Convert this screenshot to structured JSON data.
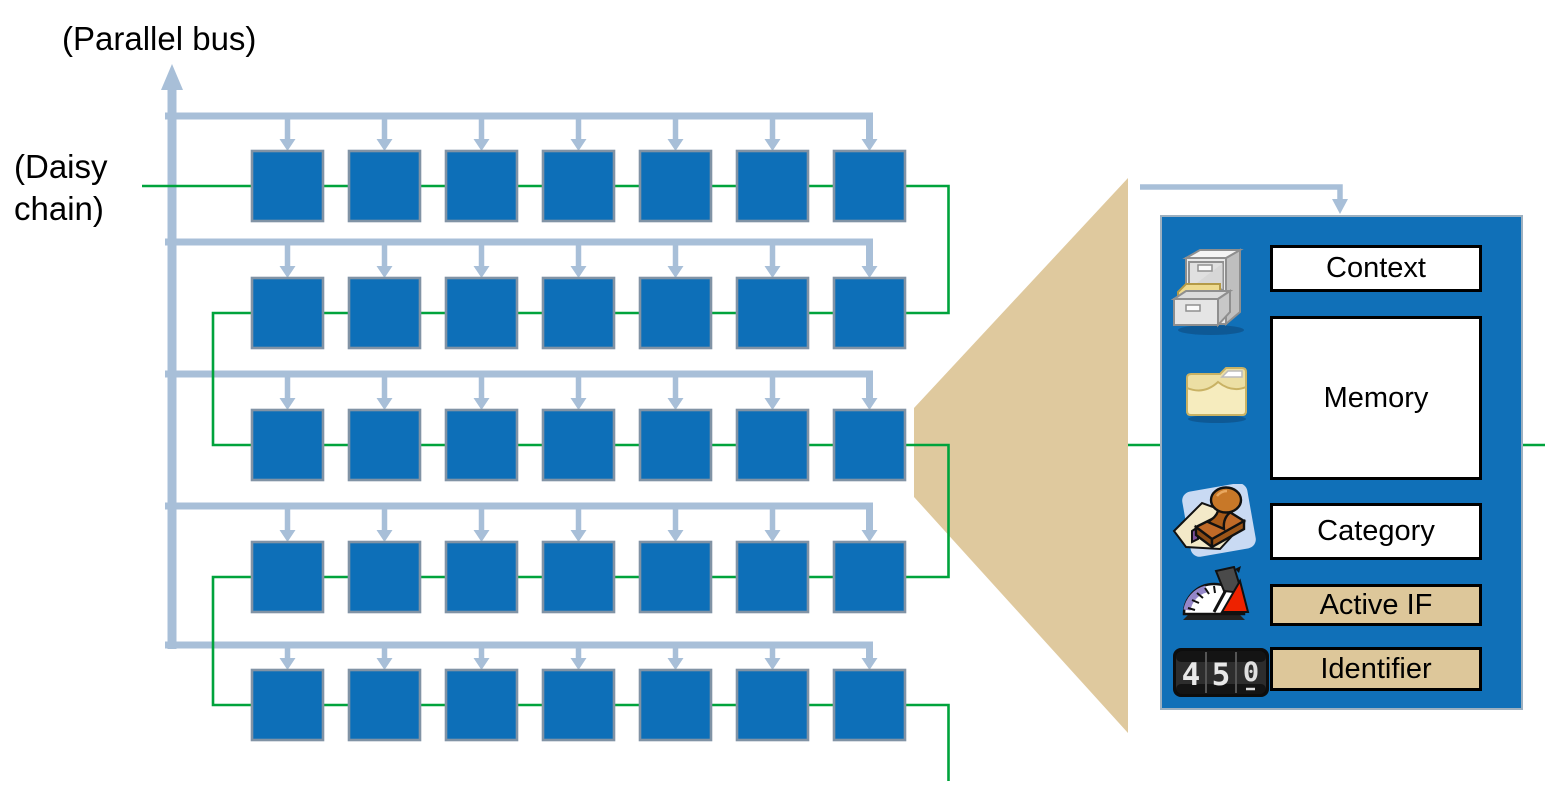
{
  "labels": {
    "parallel_bus": "(Parallel bus)",
    "daisy_chain_line1": "(Daisy",
    "daisy_chain_line2": "chain)"
  },
  "grid": {
    "rows": 5,
    "cols": 7
  },
  "zoom_panel": {
    "fields": [
      {
        "label": "Context",
        "fill": "white",
        "icon": "file-cabinet-icon"
      },
      {
        "label": "Memory",
        "fill": "white",
        "icon": "folder-icon"
      },
      {
        "label": "Category",
        "fill": "white",
        "icon": "stamp-icon"
      },
      {
        "label": "Active IF",
        "fill": "tan",
        "icon": "gauge-icon"
      },
      {
        "label": "Identifier",
        "fill": "tan",
        "icon": "counter-icon"
      }
    ],
    "counter_digits": [
      "4",
      "5",
      "0"
    ]
  },
  "colors": {
    "node_blue": "#0d6fb8",
    "node_border": "#8193a5",
    "bus_blue": "#a8bfd8",
    "chain_green": "#00a33c",
    "cone_tan": "#dfc99e",
    "tan_box": "#ddc79a",
    "panel_blue": "#1070b8"
  }
}
